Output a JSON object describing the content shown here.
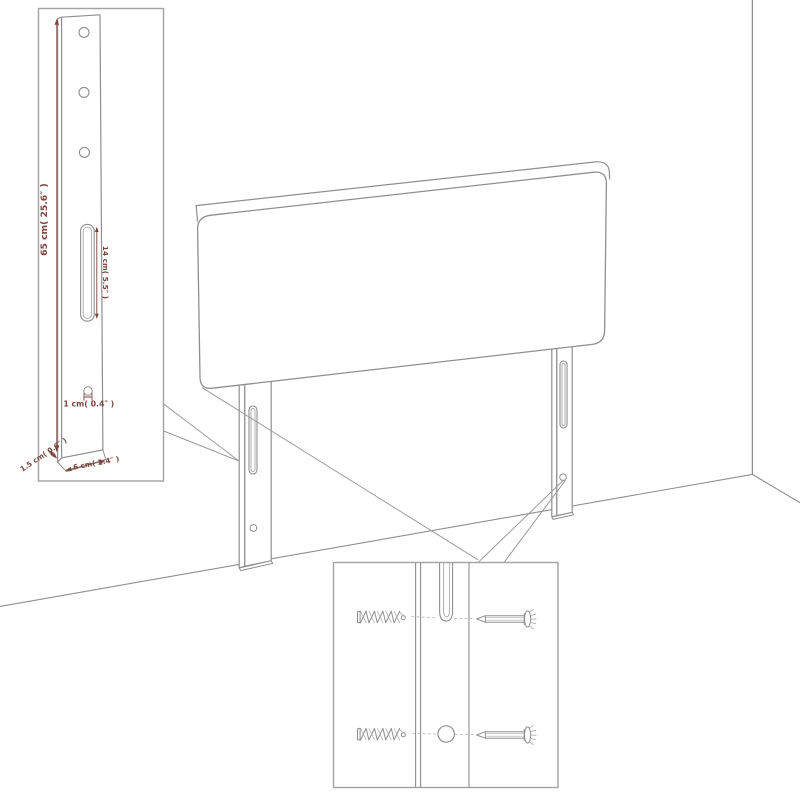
{
  "figure": {
    "type": "assembly-diagram",
    "subject": "upholstered headboard with two mounting struts, wall corner backdrop, detail insets"
  },
  "colors": {
    "background": "#ffffff",
    "outline_gray": "#8f8f8f",
    "inset_border": "#a3a3a3",
    "dimension_color": "#7a453c"
  },
  "strut_inset": {
    "dim_height": "65 cm( 25.6″ )",
    "dim_slot": "14 cm( 5.5″ )",
    "dim_hole": "1 cm( 0.4″ )",
    "dim_depth": "1.5 cm( 0.6″ )",
    "dim_width": "6 cm( 2.4″ )"
  }
}
